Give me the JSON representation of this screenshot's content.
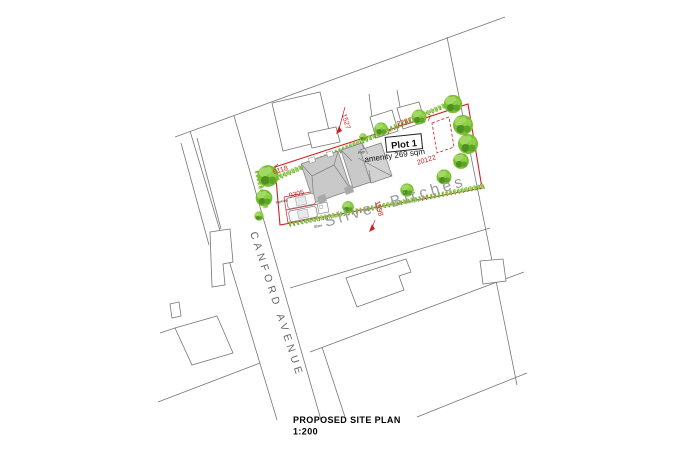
{
  "drawing": {
    "title": "PROPOSED SITE PLAN",
    "scale": "1:200",
    "roads": {
      "canford_avenue": "CANFORD AVENUE",
      "silver_birches": "Silver Birches"
    },
    "plot": {
      "label": "Plot 1",
      "amenity": "amenity 269 sqm"
    },
    "dimensions": {
      "top_gap": "1527",
      "ne_width": "2287",
      "frontage": "20122",
      "road_gap": "1598",
      "west_width": "6118",
      "parking_width": "9305"
    },
    "annotations": {
      "path": "Path",
      "store": "Store",
      "parking": "Parking"
    },
    "colors": {
      "boundary": "#cc2020",
      "hedge": "#8cc63f",
      "tree": "#79bf31",
      "tree_dark": "#4d9220",
      "tree_light": "#a2d964",
      "roof": "#c9c9c9",
      "lines": "#767676",
      "street_name": "#9b9b9b",
      "road_name": "#666666"
    }
  }
}
